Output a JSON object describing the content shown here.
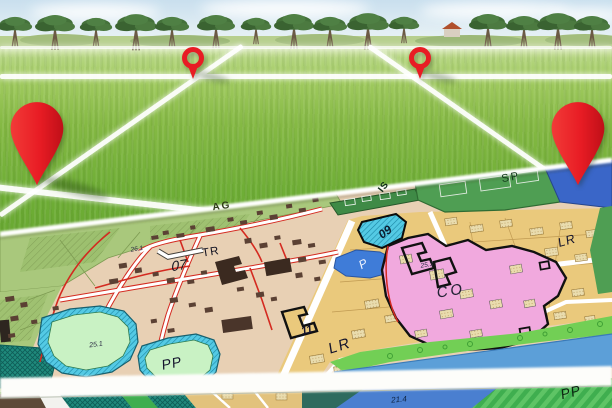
{
  "scene": {
    "foreground": "green-field-photo-with-perspective-grid",
    "overlay": "zoning-city-map-sheet"
  },
  "labels": {
    "ag": "AG",
    "tr": "TR",
    "zone_07": "07",
    "parcel_26_1": "26.1",
    "is": "IS",
    "sp": "SP",
    "zone_09": "09",
    "parking_p": "P",
    "parcel_25_3": "25.3",
    "co": "CO",
    "lr_right": "LR",
    "lr_left": "LR",
    "zone_11": "11",
    "parcel_25_1": "25.1",
    "pp_pond": "PP",
    "parcel_21_4": "21.4",
    "pp_bottom": "PP"
  },
  "icons": {
    "pin_large_left": "location-pin",
    "pin_small_left": "location-pin",
    "pin_small_right": "location-pin",
    "pin_large_right": "location-pin"
  },
  "colors": {
    "pin_red": "#e92025",
    "pin_red_dark": "#bf0f18",
    "grid_white": "#ffffff",
    "agricultural_green": "#a9c87c",
    "town_beige": "#e8d0b4",
    "building_brown": "#5b4134",
    "residential_tan": "#eac97c",
    "co_pink": "#f1a9de",
    "parking_blue": "#3f7cd8",
    "zone09_cyan": "#54cae4",
    "sp_green": "#4f9e53",
    "lake_blue": "#3a66c8",
    "river_blue": "#5c9fd8",
    "pond_green": "#c9f2c4",
    "boundary_red": "#d42a20"
  }
}
